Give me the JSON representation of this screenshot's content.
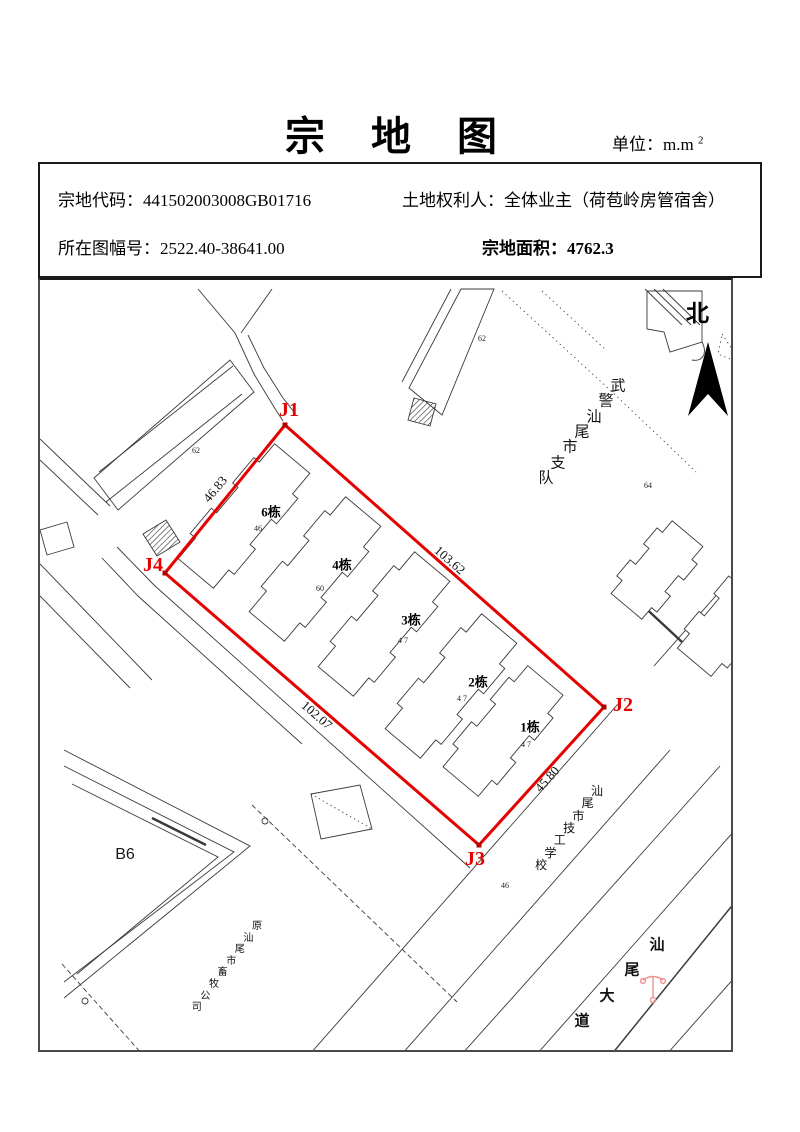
{
  "title": "宗 地 图",
  "unit": {
    "label": "单位：m.m",
    "sup": "2"
  },
  "info": {
    "parcel_code_label": "宗地代码：",
    "parcel_code": "441502003008GB01716",
    "sheet_no_label": "所在图幅号：",
    "sheet_no": "2522.40-38641.00",
    "owner_label": "土地权利人：",
    "owner": "全体业主（荷苞岭房管宿舍）",
    "area_label": "宗地面积：",
    "area_value": "4762.3"
  },
  "map": {
    "north_label": "北",
    "parcel": {
      "color": "#e60000",
      "vertices": [
        {
          "name": "J1",
          "x": 283,
          "y": 423,
          "lx": 287,
          "ly": 408
        },
        {
          "name": "J2",
          "x": 602,
          "y": 705,
          "lx": 621,
          "ly": 703
        },
        {
          "name": "J3",
          "x": 477,
          "y": 843,
          "lx": 473,
          "ly": 857
        },
        {
          "name": "J4",
          "x": 163,
          "y": 571,
          "lx": 151,
          "ly": 563
        }
      ],
      "edge_labels": [
        {
          "text": "46.83",
          "x": 213,
          "y": 487,
          "angle": -50
        },
        {
          "text": "103.62",
          "x": 448,
          "y": 558,
          "angle": 41
        },
        {
          "text": "102.07",
          "x": 315,
          "y": 713,
          "angle": 41
        },
        {
          "text": "45.80",
          "x": 545,
          "y": 777,
          "angle": -48
        }
      ]
    },
    "buildings": [
      {
        "label": "6栋",
        "x": 269,
        "y": 510
      },
      {
        "label": "4栋",
        "x": 340,
        "y": 563
      },
      {
        "label": "3栋",
        "x": 409,
        "y": 618
      },
      {
        "label": "2栋",
        "x": 476,
        "y": 680
      },
      {
        "label": "1栋",
        "x": 528,
        "y": 725
      }
    ],
    "annotations": [
      {
        "text": "62",
        "x": 194,
        "y": 449
      },
      {
        "text": "62",
        "x": 480,
        "y": 337
      },
      {
        "text": "46",
        "x": 256,
        "y": 527
      },
      {
        "text": "60",
        "x": 318,
        "y": 587
      },
      {
        "text": "4 7",
        "x": 401,
        "y": 639
      },
      {
        "text": "4 7",
        "x": 460,
        "y": 697
      },
      {
        "text": "4 7",
        "x": 524,
        "y": 743
      },
      {
        "text": "64",
        "x": 646,
        "y": 484
      },
      {
        "text": "46",
        "x": 503,
        "y": 884
      }
    ],
    "area_labels": [
      {
        "text": "B6",
        "x": 123,
        "y": 853
      }
    ],
    "diagonal_texts": [
      {
        "name": "armed-police-unit",
        "text": "武警汕尾市支队",
        "x": 616,
        "y": 385,
        "dx": -12,
        "dy": 15.3,
        "size": 15,
        "weight": "normal"
      },
      {
        "name": "technical-school",
        "text": "汕尾市技工学校",
        "x": 595,
        "y": 789,
        "dx": -9.3,
        "dy": 12.3,
        "size": 12,
        "weight": "normal"
      },
      {
        "name": "shanwei-avenue",
        "text": "汕尾大道",
        "x": 655,
        "y": 944,
        "dx": -25,
        "dy": 25.3,
        "size": 15,
        "weight": "bold"
      },
      {
        "name": "former-company",
        "text": "原汕尾市畜牧公司",
        "x": 255,
        "y": 925,
        "dx": -8.6,
        "dy": 11.6,
        "size": 10,
        "weight": "normal"
      }
    ]
  }
}
